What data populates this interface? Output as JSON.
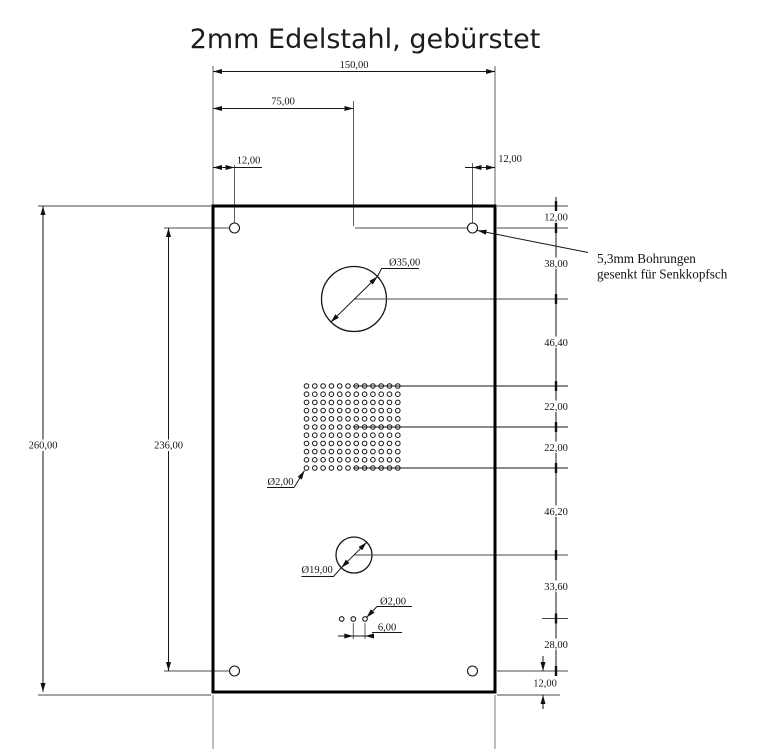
{
  "title": "2mm Edelstahl, gebürstet",
  "callout": {
    "line1": "5,3mm Bohrungen",
    "line2": "gesenkt für Senkkopfsch"
  },
  "dims": {
    "overall_width": "150,00",
    "half_width": "75,00",
    "top_left_inset": "12,00",
    "top_right_inset": "12,00",
    "overall_height": "260,00",
    "hole_span_height": "236,00",
    "bottom_right_inset": "12,00",
    "small_hole_pitch": "6,00"
  },
  "right_chain": [
    "12,00",
    "38,00",
    "46,40",
    "22,00",
    "22,00",
    "46,20",
    "33,60",
    "28,00"
  ],
  "labels": {
    "large_circle_dia": "Ø35,00",
    "medium_circle_dia": "Ø19,00",
    "grid_hole_dia": "Ø2,00",
    "small_hole_dia": "Ø2,00"
  },
  "colors": {
    "line": "#161616",
    "extension": "#4a4a4a",
    "background": "#ffffff"
  }
}
